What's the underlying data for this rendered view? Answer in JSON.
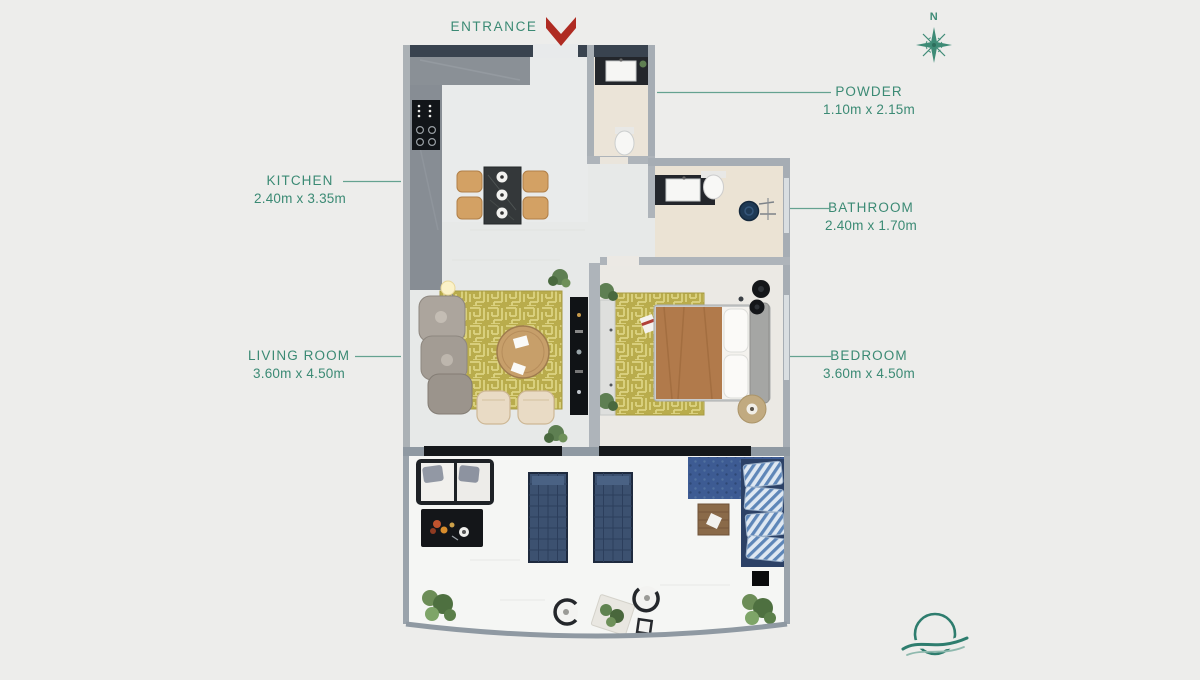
{
  "canvas": {
    "background": "#EDEDEB",
    "width": 1200,
    "height": 680
  },
  "palette": {
    "label_teal": "#3B8A74",
    "leader_line_teal": "#4E9681",
    "entrance_arrow_red": "#AF2B22",
    "wall_dark": "#39434F",
    "wall_light": "#A6ADB4",
    "rug_olive": "#B9AC4C",
    "lounger_blue": "#3C5170",
    "balcony_sofa_blue": "#2C4166",
    "logo_teal": "#2E7D6E"
  },
  "entrance": {
    "label": "ENTRANCE"
  },
  "compass": {
    "north_label": "N"
  },
  "rooms": [
    {
      "id": "kitchen",
      "label": "KITCHEN",
      "dimensions": "2.40m x 3.35m",
      "label_side": "left"
    },
    {
      "id": "living_room",
      "label": "LIVING ROOM",
      "dimensions": "3.60m x 4.50m",
      "label_side": "left"
    },
    {
      "id": "powder",
      "label": "POWDER",
      "dimensions": "1.10m x 2.15m",
      "label_side": "right"
    },
    {
      "id": "bathroom",
      "label": "BATHROOM",
      "dimensions": "2.40m x 1.70m",
      "label_side": "right"
    },
    {
      "id": "bedroom",
      "label": "BEDROOM",
      "dimensions": "3.60m x 4.50m",
      "label_side": "right"
    }
  ]
}
